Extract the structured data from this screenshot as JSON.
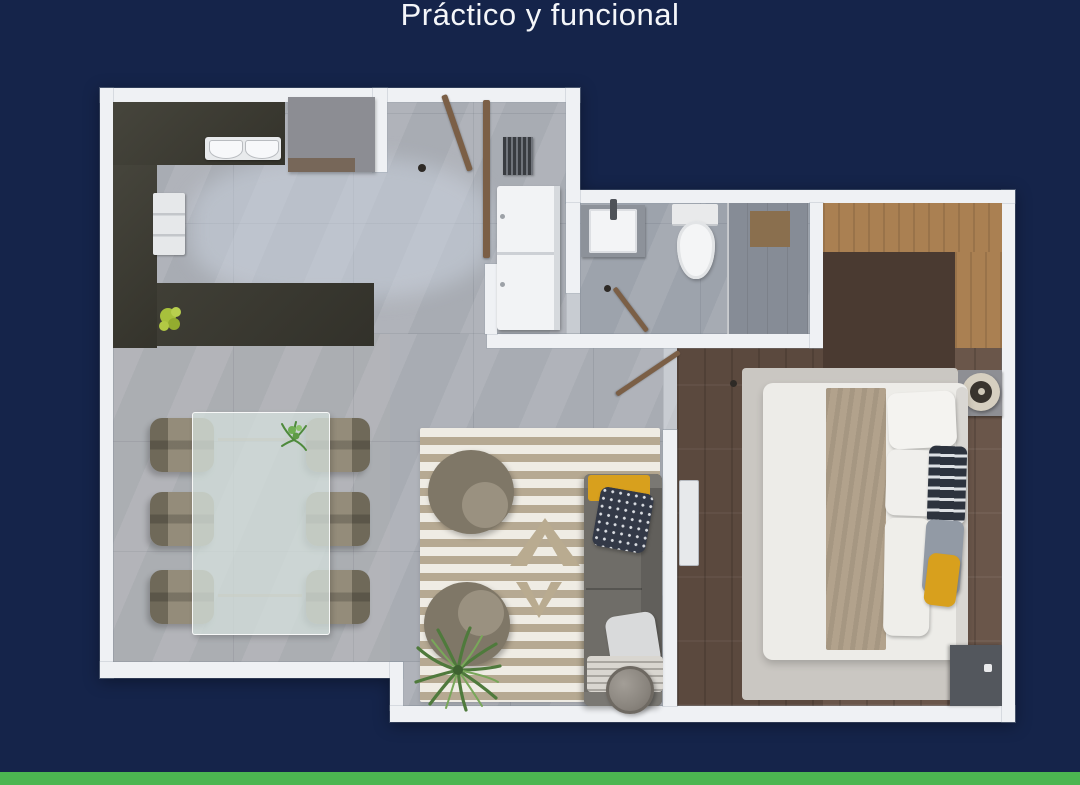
{
  "title": "Práctico y funcional",
  "colors": {
    "bg": "#15244A",
    "accent": "#4CB551",
    "wall": "#EFF1F4",
    "floor-marble": "#A8ACB3",
    "floor-wood": "#6A564A",
    "counter": "#3B3A31",
    "closet-wood": "#AA8052",
    "sofa": "#6F6D68",
    "rug-stripe": "#B6A992",
    "pillow-yellow": "#D8A01D",
    "plant-green": "#5E8A45",
    "title-text": "#F4F6F9"
  },
  "floorplan": {
    "style": "top-down 3D render",
    "rooms": [
      "kitchen",
      "hallway",
      "bathroom",
      "bedroom",
      "living-room",
      "dining-area"
    ]
  }
}
